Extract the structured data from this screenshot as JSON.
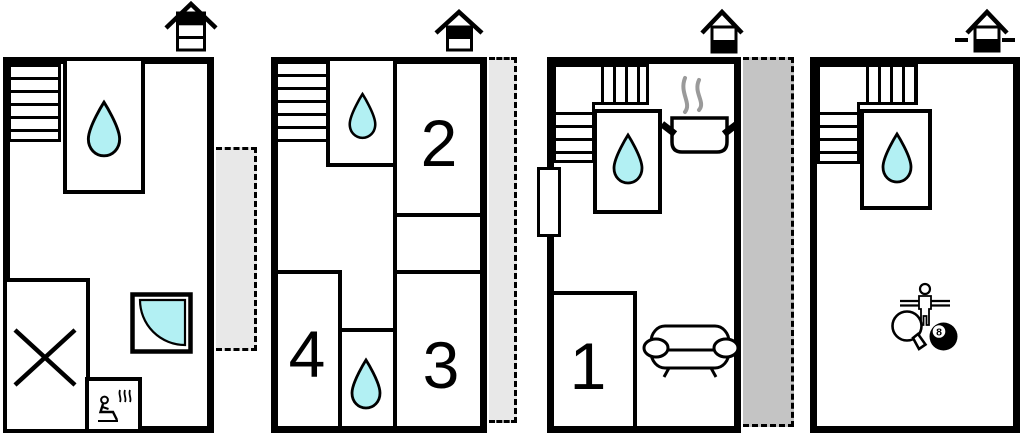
{
  "colors": {
    "wall": "#000000",
    "water": "#b2f0f3",
    "balcony_light": "#e8e8e8",
    "terrace_dark": "#c4c4c4",
    "steam": "#9a9a9a",
    "paper": "#ffffff"
  },
  "labels": {
    "room_1": "1",
    "room_2": "2",
    "room_3": "3",
    "room_4": "4",
    "eight_ball": "8"
  },
  "floors": [
    {
      "name": "top-floor",
      "level_icon": {
        "bands": 3,
        "filled_band": "top",
        "below_ground_dashes": false
      },
      "features": [
        "staircase",
        "water-drop-room",
        "crossed-room",
        "shower",
        "sauna",
        "side-balcony"
      ]
    },
    {
      "name": "upper-floor",
      "level_icon": {
        "bands": 2,
        "filled_band": "top",
        "below_ground_dashes": false
      },
      "features": [
        "staircase",
        "water-drop-room",
        "room-2",
        "room-3",
        "room-4",
        "water-drop-room",
        "side-balcony"
      ]
    },
    {
      "name": "ground-floor",
      "level_icon": {
        "bands": 2,
        "filled_band": "bottom",
        "below_ground_dashes": false
      },
      "features": [
        "staircase",
        "water-drop-room",
        "kitchen-pot",
        "room-1",
        "sofa",
        "entrance-door",
        "side-terrace"
      ]
    },
    {
      "name": "basement",
      "level_icon": {
        "bands": 2,
        "filled_band": "bottom",
        "below_ground_dashes": true
      },
      "features": [
        "staircase",
        "water-drop-room",
        "foosball",
        "table-tennis",
        "billiards"
      ]
    }
  ]
}
